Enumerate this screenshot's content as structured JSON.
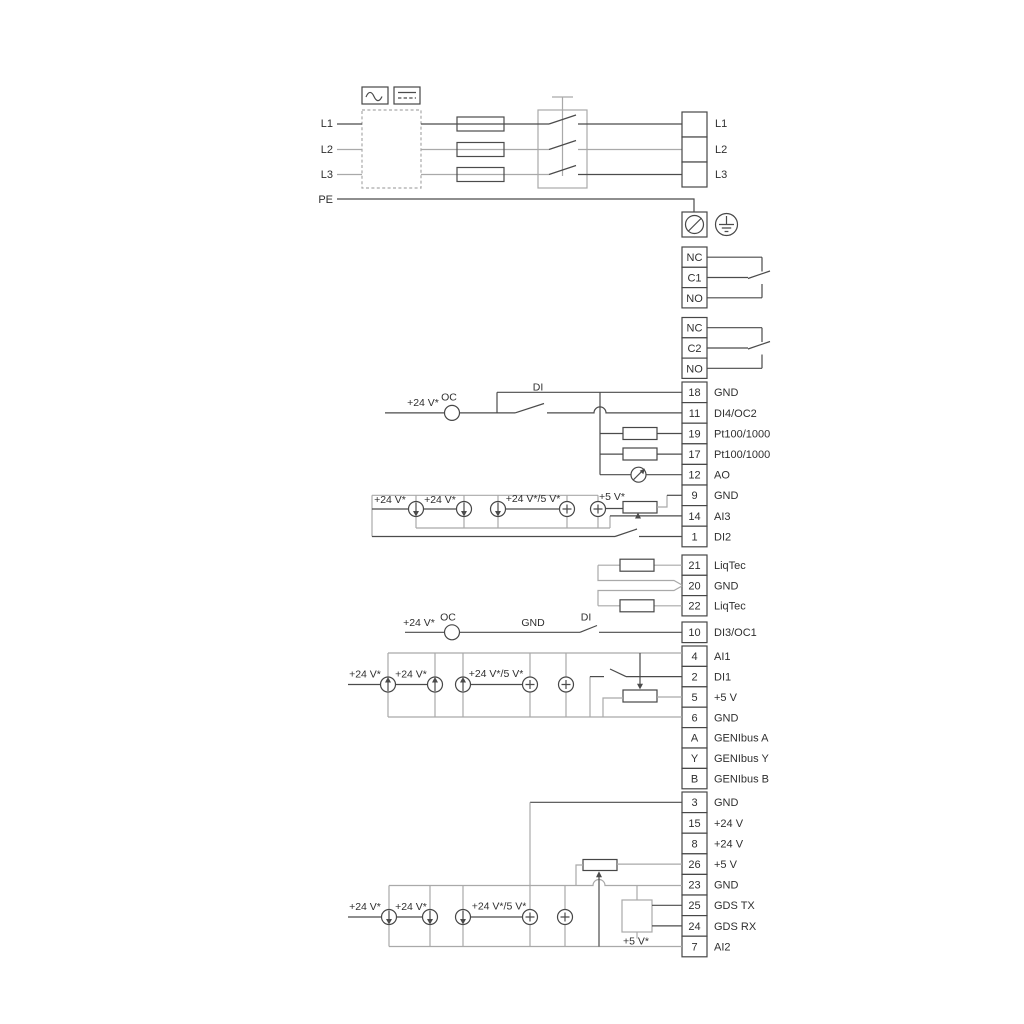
{
  "power": {
    "inputs": [
      "L1",
      "L2",
      "L3",
      "PE"
    ],
    "outputs": [
      "L1",
      "L2",
      "L3"
    ]
  },
  "relays": {
    "r1": [
      "NC",
      "C1",
      "NO"
    ],
    "r2": [
      "NC",
      "C2",
      "NO"
    ]
  },
  "blocks": {
    "a": [
      {
        "num": "18",
        "label": "GND"
      },
      {
        "num": "11",
        "label": "DI4/OC2"
      },
      {
        "num": "19",
        "label": "Pt100/1000"
      },
      {
        "num": "17",
        "label": "Pt100/1000"
      },
      {
        "num": "12",
        "label": "AO"
      },
      {
        "num": "9",
        "label": "GND"
      },
      {
        "num": "14",
        "label": "AI3"
      },
      {
        "num": "1",
        "label": "DI2"
      }
    ],
    "liqtec": [
      {
        "num": "21",
        "label": "LiqTec"
      },
      {
        "num": "20",
        "label": "GND"
      },
      {
        "num": "22",
        "label": "LiqTec"
      }
    ],
    "di3": {
      "num": "10",
      "label": "DI3/OC1"
    },
    "b": [
      {
        "num": "4",
        "label": "AI1"
      },
      {
        "num": "2",
        "label": "DI1"
      },
      {
        "num": "5",
        "label": "+5 V"
      },
      {
        "num": "6",
        "label": "GND"
      },
      {
        "num": "A",
        "label": "GENIbus A"
      },
      {
        "num": "Y",
        "label": "GENIbus Y"
      },
      {
        "num": "B",
        "label": "GENIbus B"
      }
    ],
    "c": [
      {
        "num": "3",
        "label": "GND"
      },
      {
        "num": "15",
        "label": "+24 V"
      },
      {
        "num": "8",
        "label": "+24 V"
      },
      {
        "num": "26",
        "label": "+5 V"
      },
      {
        "num": "23",
        "label": "GND"
      },
      {
        "num": "25",
        "label": "GDS TX"
      },
      {
        "num": "24",
        "label": "GDS RX"
      },
      {
        "num": "7",
        "label": "AI2"
      }
    ]
  },
  "annotations": {
    "plus24": "+24 V*",
    "plus24or5": "+24 V*/5 V*",
    "plus5": "+5 V*",
    "oc": "OC",
    "di": "DI",
    "gnd": "GND"
  },
  "colors": {
    "wire_light": "#a9a9a9",
    "wire_dark": "#4b4b4b",
    "text": "#2f2f2f",
    "background": "#ffffff"
  }
}
